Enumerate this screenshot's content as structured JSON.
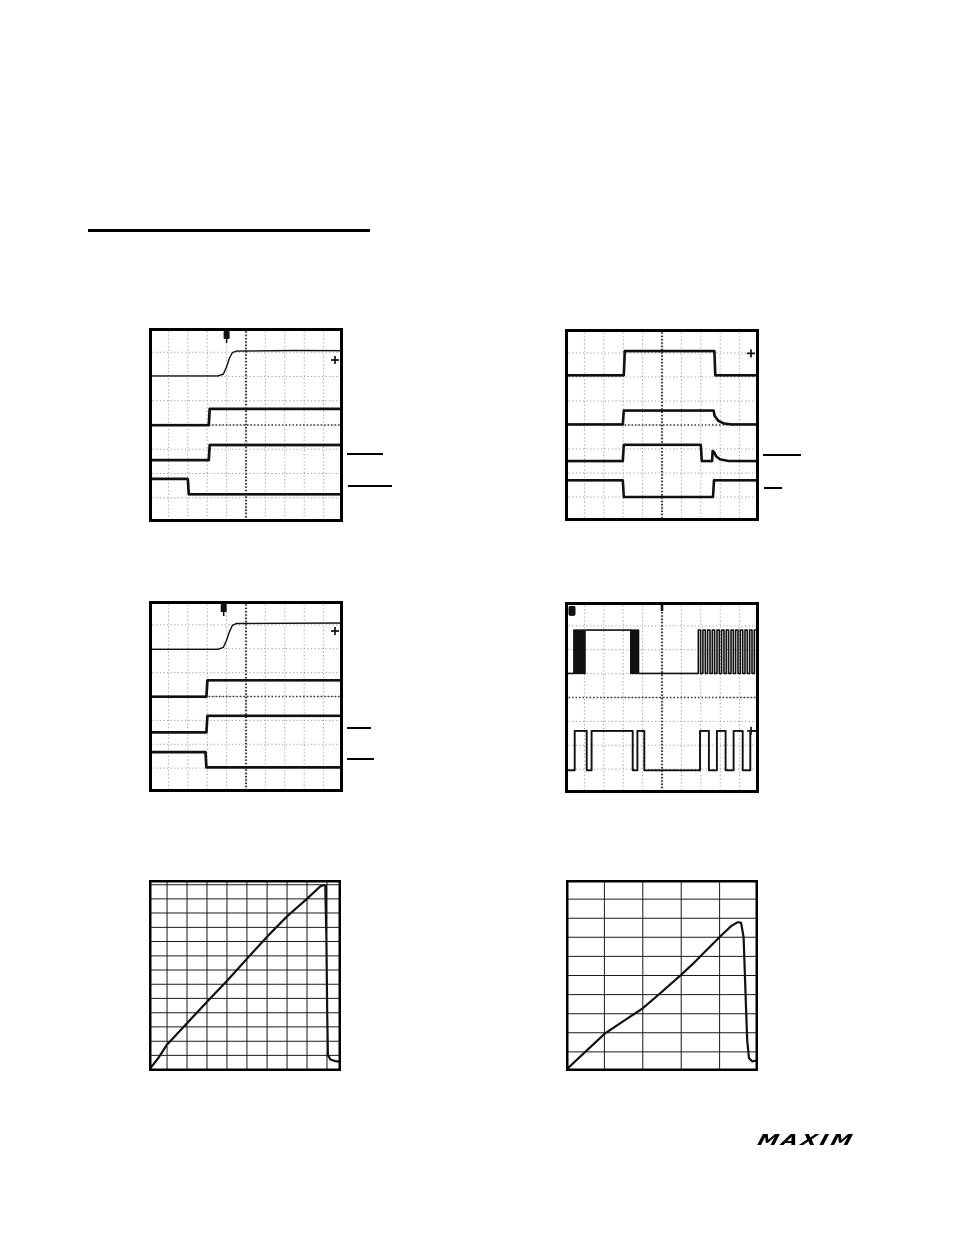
{
  "page": {
    "width": 954,
    "height": 1235,
    "bg": "#ffffff",
    "ink": "#111111",
    "heading_underline": {
      "x": 88,
      "y": 229,
      "w": 282,
      "h": 3
    },
    "logo": {
      "text": "MAXIM",
      "x": 756,
      "y": 1126,
      "h": 22
    }
  },
  "level_markers": [
    {
      "x": 347,
      "y": 453,
      "w": 36,
      "h": 2
    },
    {
      "x": 348,
      "y": 485,
      "w": 44,
      "h": 2
    },
    {
      "x": 763,
      "y": 454,
      "w": 38,
      "h": 2
    },
    {
      "x": 764,
      "y": 487,
      "w": 18,
      "h": 2
    },
    {
      "x": 347,
      "y": 727,
      "w": 24,
      "h": 2
    },
    {
      "x": 347,
      "y": 758,
      "w": 27,
      "h": 2
    }
  ],
  "chart_data": [
    {
      "id": "scope-top-left",
      "type": "line",
      "style": "oscilloscope",
      "frame": {
        "x": 149,
        "y": 328,
        "w": 194,
        "h": 194
      },
      "border_width": 3,
      "grid": {
        "vlines": [
          0.1,
          0.2,
          0.3,
          0.4,
          0.5,
          0.6,
          0.7,
          0.8,
          0.9
        ],
        "hlines": [
          0.125,
          0.25,
          0.375,
          0.5,
          0.625,
          0.75,
          0.875
        ],
        "center_v": 0.5,
        "center_h": 0.5,
        "minor_color": "#9b9b9b",
        "center_color": "#3f3f3f",
        "dotted": true
      },
      "series": [
        {
          "name": "trace1-rising-edge",
          "width": 1.4,
          "points": [
            [
              0,
              0.247
            ],
            [
              0.355,
              0.247
            ],
            [
              0.383,
              0.238
            ],
            [
              0.4,
              0.2
            ],
            [
              0.415,
              0.155
            ],
            [
              0.43,
              0.127
            ],
            [
              0.45,
              0.119
            ],
            [
              0.75,
              0.116
            ],
            [
              1,
              0.117
            ]
          ]
        },
        {
          "name": "trace2-step-up",
          "width": 2.7,
          "points": [
            [
              0,
              0.501
            ],
            [
              0.308,
              0.501
            ],
            [
              0.313,
              0.417
            ],
            [
              1,
              0.417
            ]
          ]
        },
        {
          "name": "trace3-step-up",
          "width": 2.7,
          "points": [
            [
              0,
              0.681
            ],
            [
              0.308,
              0.681
            ],
            [
              0.313,
              0.603
            ],
            [
              1,
              0.603
            ]
          ]
        },
        {
          "name": "trace4-step-down",
          "width": 2.7,
          "points": [
            [
              0,
              0.778
            ],
            [
              0.2,
              0.778
            ],
            [
              0.205,
              0.857
            ],
            [
              1,
              0.857
            ]
          ]
        }
      ],
      "markers": {
        "trigger_x": 0.4,
        "right_arrow_y": 0.165
      }
    },
    {
      "id": "scope-top-right",
      "type": "line",
      "style": "oscilloscope",
      "frame": {
        "x": 565,
        "y": 329,
        "w": 194,
        "h": 192
      },
      "border_width": 3,
      "grid": {
        "vlines": [
          0.1,
          0.2,
          0.3,
          0.4,
          0.5,
          0.6,
          0.7,
          0.8,
          0.9
        ],
        "hlines": [
          0.125,
          0.25,
          0.375,
          0.5,
          0.625,
          0.75,
          0.875
        ],
        "center_v": 0.5,
        "center_h": 0.5,
        "minor_color": "#9b9b9b",
        "center_color": "#3f3f3f",
        "dotted": true
      },
      "series": [
        {
          "name": "trace1-pulse",
          "width": 2.6,
          "points": [
            [
              0,
              0.241
            ],
            [
              0.303,
              0.241
            ],
            [
              0.308,
              0.115
            ],
            [
              0.77,
              0.115
            ],
            [
              0.775,
              0.241
            ],
            [
              1,
              0.241
            ]
          ]
        },
        {
          "name": "trace2-pulse-decay",
          "width": 2.6,
          "points": [
            [
              0,
              0.497
            ],
            [
              0.298,
              0.497
            ],
            [
              0.303,
              0.425
            ],
            [
              0.766,
              0.425
            ],
            [
              0.771,
              0.452
            ],
            [
              0.79,
              0.478
            ],
            [
              0.82,
              0.492
            ],
            [
              0.86,
              0.497
            ],
            [
              1,
              0.497
            ]
          ]
        },
        {
          "name": "trace3-pulse-spike",
          "width": 2.6,
          "points": [
            [
              0,
              0.688
            ],
            [
              0.298,
              0.688
            ],
            [
              0.303,
              0.603
            ],
            [
              0.7,
              0.603
            ],
            [
              0.705,
              0.688
            ],
            [
              0.758,
              0.688
            ],
            [
              0.761,
              0.636
            ],
            [
              0.768,
              0.641
            ],
            [
              0.78,
              0.664
            ],
            [
              0.8,
              0.679
            ],
            [
              0.84,
              0.687
            ],
            [
              1,
              0.688
            ]
          ]
        },
        {
          "name": "trace4-inverted-pulse",
          "width": 2.6,
          "points": [
            [
              0,
              0.788
            ],
            [
              0.298,
              0.788
            ],
            [
              0.303,
              0.875
            ],
            [
              0.763,
              0.875
            ],
            [
              0.768,
              0.788
            ],
            [
              1,
              0.788
            ]
          ]
        }
      ],
      "markers": {
        "right_arrow_y": 0.127
      }
    },
    {
      "id": "scope-mid-left",
      "type": "line",
      "style": "oscilloscope",
      "frame": {
        "x": 149,
        "y": 601,
        "w": 194,
        "h": 191
      },
      "border_width": 3,
      "grid": {
        "vlines": [
          0.1,
          0.2,
          0.3,
          0.4,
          0.5,
          0.6,
          0.7,
          0.8,
          0.9
        ],
        "hlines": [
          0.125,
          0.25,
          0.375,
          0.5,
          0.625,
          0.75,
          0.875
        ],
        "center_v": 0.5,
        "center_h": 0.5,
        "minor_color": "#9b9b9b",
        "center_color": "#3f3f3f",
        "dotted": true
      },
      "series": [
        {
          "name": "trace1-rising-edge",
          "width": 1.4,
          "points": [
            [
              0,
              0.253
            ],
            [
              0.355,
              0.253
            ],
            [
              0.383,
              0.243
            ],
            [
              0.4,
              0.205
            ],
            [
              0.415,
              0.16
            ],
            [
              0.43,
              0.128
            ],
            [
              0.45,
              0.118
            ],
            [
              1,
              0.115
            ]
          ]
        },
        {
          "name": "trace2-step-up",
          "width": 2.7,
          "points": [
            [
              0,
              0.501
            ],
            [
              0.296,
              0.501
            ],
            [
              0.301,
              0.415
            ],
            [
              1,
              0.415
            ]
          ]
        },
        {
          "name": "trace3-step-up",
          "width": 2.7,
          "points": [
            [
              0,
              0.688
            ],
            [
              0.296,
              0.688
            ],
            [
              0.301,
              0.601
            ],
            [
              1,
              0.601
            ]
          ]
        },
        {
          "name": "trace4-step-down",
          "width": 2.7,
          "points": [
            [
              0,
              0.791
            ],
            [
              0.291,
              0.791
            ],
            [
              0.296,
              0.871
            ],
            [
              1,
              0.871
            ]
          ]
        }
      ],
      "markers": {
        "trigger_x": 0.385,
        "right_arrow_y": 0.157
      }
    },
    {
      "id": "scope-mid-right",
      "type": "line",
      "style": "oscilloscope",
      "frame": {
        "x": 565,
        "y": 602,
        "w": 194,
        "h": 191
      },
      "border_width": 3,
      "grid": {
        "vlines": [
          0.1,
          0.2,
          0.3,
          0.4,
          0.5,
          0.6,
          0.7,
          0.8,
          0.9
        ],
        "hlines": [
          0.125,
          0.25,
          0.375,
          0.5,
          0.625,
          0.75,
          0.875
        ],
        "center_v": 0.5,
        "center_h": 0.5,
        "minor_color": "#9b9b9b",
        "center_color": "#3f3f3f",
        "dotted": true
      },
      "series": [
        {
          "name": "trace1-switching-bursts",
          "width": 1.6,
          "wave": {
            "high": 0.147,
            "low": 0.374,
            "segments": [
              {
                "s": "low",
                "a": 0,
                "b": 0.046
              },
              {
                "s": "burst",
                "a": 0.046,
                "b": 0.103,
                "n": 4
              },
              {
                "s": "high",
                "a": 0.103,
                "b": 0.339
              },
              {
                "s": "burst",
                "a": 0.339,
                "b": 0.387,
                "n": 3
              },
              {
                "s": "low",
                "a": 0.387,
                "b": 0.687
              },
              {
                "s": "burst",
                "a": 0.687,
                "b": 1.0,
                "n": 13
              }
            ]
          }
        },
        {
          "name": "trace2-pulse-train",
          "width": 1.9,
          "wave": {
            "high": 0.675,
            "low": 0.881,
            "segments": [
              {
                "s": "low",
                "a": 0,
                "b": 0.05
              },
              {
                "s": "high",
                "a": 0.05,
                "b": 0.112
              },
              {
                "s": "low",
                "a": 0.112,
                "b": 0.137
              },
              {
                "s": "high",
                "a": 0.137,
                "b": 0.349
              },
              {
                "s": "low",
                "a": 0.349,
                "b": 0.373
              },
              {
                "s": "high",
                "a": 0.373,
                "b": 0.409
              },
              {
                "s": "low",
                "a": 0.409,
                "b": 0.696
              },
              {
                "s": "high",
                "a": 0.696,
                "b": 0.742
              },
              {
                "s": "low",
                "a": 0.742,
                "b": 0.783
              },
              {
                "s": "high",
                "a": 0.783,
                "b": 0.828
              },
              {
                "s": "low",
                "a": 0.828,
                "b": 0.869
              },
              {
                "s": "high",
                "a": 0.869,
                "b": 0.916
              },
              {
                "s": "low",
                "a": 0.916,
                "b": 0.955
              },
              {
                "s": "high",
                "a": 0.955,
                "b": 1.0
              }
            ]
          }
        }
      ],
      "markers": {
        "corner_box": [
          0.018,
          0.02
        ],
        "right_arrow_y": 0.675,
        "top_center_tick": true
      }
    },
    {
      "id": "graph-bottom-left",
      "type": "line",
      "style": "graph",
      "frame": {
        "x": 149,
        "y": 880,
        "w": 192,
        "h": 191
      },
      "border_width": 2.5,
      "grid": {
        "vlines": [
          0.094,
          0.198,
          0.302,
          0.406,
          0.51,
          0.615,
          0.719,
          0.823,
          0.927
        ],
        "hlines": [
          0.025,
          0.099,
          0.173,
          0.248,
          0.322,
          0.397,
          0.471,
          0.546,
          0.62,
          0.695,
          0.769,
          0.844,
          0.918
        ],
        "minor_color": "#1a1a1a",
        "dotted": false
      },
      "series": [
        {
          "name": "ramp-and-drop-curve",
          "width": 2.2,
          "points": [
            [
              0,
              0.995
            ],
            [
              0.05,
              0.93
            ],
            [
              0.092,
              0.864
            ],
            [
              0.205,
              0.742
            ],
            [
              0.307,
              0.633
            ],
            [
              0.41,
              0.524
            ],
            [
              0.512,
              0.41
            ],
            [
              0.615,
              0.297
            ],
            [
              0.717,
              0.192
            ],
            [
              0.82,
              0.101
            ],
            [
              0.89,
              0.035
            ],
            [
              0.908,
              0.026
            ],
            [
              0.918,
              0.03
            ],
            [
              0.924,
              0.3
            ],
            [
              0.928,
              0.7
            ],
            [
              0.932,
              0.915
            ],
            [
              0.945,
              0.94
            ],
            [
              0.97,
              0.948
            ],
            [
              1,
              0.952
            ]
          ]
        }
      ],
      "markers": {}
    },
    {
      "id": "graph-bottom-right",
      "type": "line",
      "style": "graph",
      "frame": {
        "x": 566,
        "y": 880,
        "w": 192,
        "h": 191
      },
      "border_width": 2.5,
      "grid": {
        "vlines": [
          0.2,
          0.4,
          0.6,
          0.8
        ],
        "hlines": [
          0.1,
          0.2,
          0.3,
          0.4,
          0.5,
          0.6,
          0.7,
          0.8,
          0.9
        ],
        "minor_color": "#1a1a1a",
        "dotted": false
      },
      "series": [
        {
          "name": "ramp-rounded-peak-curve",
          "width": 2.2,
          "points": [
            [
              0,
              0.995
            ],
            [
              0.1,
              0.9
            ],
            [
              0.203,
              0.803
            ],
            [
              0.3,
              0.738
            ],
            [
              0.399,
              0.672
            ],
            [
              0.5,
              0.585
            ],
            [
              0.599,
              0.497
            ],
            [
              0.665,
              0.435
            ],
            [
              0.724,
              0.375
            ],
            [
              0.811,
              0.288
            ],
            [
              0.862,
              0.24
            ],
            [
              0.895,
              0.221
            ],
            [
              0.912,
              0.224
            ],
            [
              0.925,
              0.3
            ],
            [
              0.936,
              0.62
            ],
            [
              0.944,
              0.84
            ],
            [
              0.953,
              0.933
            ],
            [
              0.97,
              0.95
            ],
            [
              1,
              0.944
            ]
          ]
        }
      ],
      "markers": {}
    }
  ]
}
